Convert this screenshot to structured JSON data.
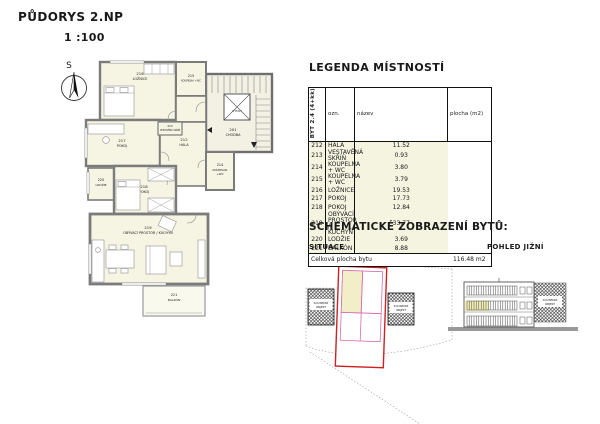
{
  "page": {
    "title": "PŮDORYS 2.NP",
    "scale": "1 :100"
  },
  "plan": {
    "north_label": "S",
    "rooms": {
      "r216": {
        "num": "216",
        "name": "LOŽNICE"
      },
      "r215": {
        "num": "215",
        "name": "KOUPELNA +WC"
      },
      "r217": {
        "num": "217",
        "name": "POKOJ"
      },
      "r213": {
        "num": "213",
        "name": "VESTAVĚNÁ SKŘÍŇ"
      },
      "r212": {
        "num": "212",
        "name": "HALA"
      },
      "r214": {
        "num": "214",
        "name": "KOUPELNA",
        "name2": "+WC"
      },
      "r218": {
        "num": "218",
        "name": "POKOJ"
      },
      "r219": {
        "num": "219",
        "name": "OBÝVACÍ PROSTOR / KUCHYŇ"
      },
      "r220": {
        "num": "220",
        "name": "LODŽIE"
      },
      "r221": {
        "num": "221",
        "name": "BALKÓN"
      },
      "r201": {
        "num": "201",
        "name": "CHODBA"
      },
      "vytah": {
        "name": "VÝTAH"
      }
    }
  },
  "legend": {
    "heading": "LEGENDA MÍSTNOSTÍ",
    "apartment_label": "BYT 2.4 (4+kk)",
    "columns": [
      "ozn.",
      "název",
      "plocha (m2)"
    ],
    "rows": [
      [
        "212",
        "HALA",
        "11.52"
      ],
      [
        "213",
        "VESTAVĚNÁ SKŘÍŇ",
        "0.93"
      ],
      [
        "214",
        "KOUPELNA + WC",
        "3.80"
      ],
      [
        "215",
        "KOUPELNA + WC",
        "3.79"
      ],
      [
        "216",
        "LOŽNICE",
        "19.53"
      ],
      [
        "217",
        "POKOJ",
        "17.73"
      ],
      [
        "218",
        "POKOJ",
        "12.84"
      ],
      [
        "219",
        "OBÝVACÍ PROSTOR / KUCHYŇ",
        "33.77"
      ],
      [
        "220",
        "LODŽIE",
        "3.69"
      ],
      [
        "221",
        "BALKÓN",
        "8.88"
      ]
    ],
    "total_label": "Celková plocha bytu",
    "total_value": "116.48 m2"
  },
  "schematic": {
    "heading": "SCHEMATICKÉ ZOBRAZENÍ BYTŮ:",
    "situace_label": "SITUACE",
    "pohled_label": "POHLED JIŽNÍ",
    "neighbor1": "SOUSEDNÍ",
    "neighbor2": "OBJEKT"
  },
  "colors": {
    "room_fill": "#f6f4e2",
    "wall_gray": "#7b7b7b",
    "outline_red": "#cc2222",
    "unit_pink": "#d66fae",
    "highlight_yellow": "#f2eec8",
    "table_row_bg": "#f5f4e1"
  }
}
